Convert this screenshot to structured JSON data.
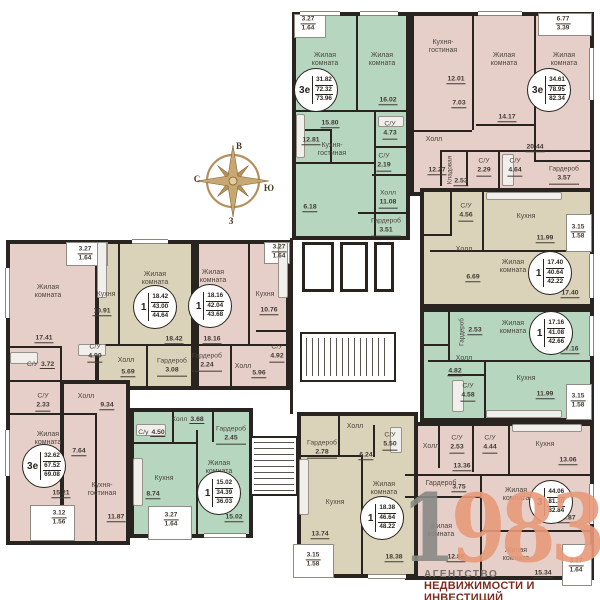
{
  "compass": {
    "top": "В",
    "left": "С",
    "right": "Ю",
    "bottom": "З"
  },
  "logo": {
    "year_gray": "1",
    "year_accent": "983",
    "line1": "АГЕНТСТВО",
    "line2": "НЕДВИЖИМОСТИ И ИНВЕСТИЦИЙ"
  },
  "colors": {
    "green": "#b7d6bf",
    "pink": "#e6cfc8",
    "beige": "#dbd3b9",
    "wall": "#29241f",
    "compass_gold": "#b3905e",
    "logo_salmon": "#e89a7a",
    "logo_gray": "#8a8a87",
    "logo_maroon": "#7c2d1e"
  },
  "apartments": [
    {
      "type": "3е",
      "v1": "31.82",
      "v2": "72.32",
      "v3": "73.96",
      "rooms": [
        {
          "name": "Жилая комната"
        },
        {
          "name": "Жилая комната",
          "area": "16.02"
        },
        {
          "name": "Кухня-гостиная",
          "area": "15.80"
        },
        {
          "area": "12.81"
        },
        {
          "area": "6.18"
        },
        {
          "name": "С/У",
          "area": "4.73"
        },
        {
          "name": "С/У",
          "area": "2.19"
        },
        {
          "name": "Холл",
          "area": "11.08"
        },
        {
          "name": "Гардероб",
          "area": "3.51"
        },
        {
          "fr1": "3.27",
          "fr2": "1.64"
        }
      ]
    },
    {
      "type": "3е",
      "v1": "34.61",
      "v2": "78.95",
      "v3": "82.34",
      "rooms": [
        {
          "name": "Кухня-гостиная",
          "area": "12.01"
        },
        {
          "name": "Жилая комната",
          "area": "14.17"
        },
        {
          "name": "Жилая комната",
          "area": "20.44"
        },
        {
          "name": "Холл",
          "area": "12.27"
        },
        {
          "area": "7.03"
        },
        {
          "name": "Кладовая",
          "area": "2.53"
        },
        {
          "name": "С/У",
          "area": "2.29"
        },
        {
          "name": "С/У",
          "area": "4.64"
        },
        {
          "name": "Гардероб",
          "area": "3.57"
        },
        {
          "fr1": "6.77",
          "fr2": "3.39"
        }
      ]
    },
    {
      "type": "1",
      "v1": "17.40",
      "v2": "40.64",
      "v3": "42.22",
      "rooms": [
        {
          "name": "Кухня",
          "area": "11.99"
        },
        {
          "name": "С/У",
          "area": "4.56"
        },
        {
          "name": "Холл",
          "area": "6.69"
        },
        {
          "name": "Жилая комната",
          "area": "17.40"
        },
        {
          "fr1": "3.15",
          "fr2": "1.58"
        }
      ]
    },
    {
      "type": "1",
      "v1": "17.16",
      "v2": "41.08",
      "v3": "42.66",
      "rooms": [
        {
          "name": "Жилая комната",
          "area": "17.16"
        },
        {
          "name": "Гардероб",
          "area": "2.53"
        },
        {
          "name": "Холл",
          "area": "4.82"
        },
        {
          "name": "С/У",
          "area": "4.58"
        },
        {
          "name": "Кухня",
          "area": "11.99"
        },
        {
          "fr1": "3.15",
          "fr2": "1.58"
        }
      ]
    },
    {
      "type": "3",
      "v1": "44.06",
      "v2": "81.20",
      "v3": "82.84",
      "rooms": [
        {
          "name": "С/У",
          "area": "2.53"
        },
        {
          "name": "С/У",
          "area": "4.44"
        },
        {
          "name": "Кухня",
          "area": "13.06"
        },
        {
          "name": "Холл",
          "area": "13.36"
        },
        {
          "name": "Гардероб",
          "area": "3.75"
        },
        {
          "name": "Жилая комната",
          "area": "15.87"
        },
        {
          "name": "Жилая комната",
          "area": "12.86"
        },
        {
          "name": "Жилая комната",
          "area": "15.34"
        },
        {
          "fr1": "3.27",
          "fr2": "1.64"
        }
      ]
    },
    {
      "type": "3е",
      "v1": "32.62",
      "v2": "67.52",
      "v3": "69.08",
      "rooms": [
        {
          "name": "Жилая комната",
          "area": "17.41"
        },
        {
          "name": "С/У",
          "area": "3.72"
        },
        {
          "name": "С/У",
          "area": "2.33"
        },
        {
          "name": "Холл",
          "area": "9.34"
        },
        {
          "area": "7.64"
        },
        {
          "name": "Жилая комната",
          "area": "15.21"
        },
        {
          "name": "Кухня-гостиная",
          "area": "11.87"
        },
        {
          "fr1": "3.27",
          "fr2": "1.64"
        },
        {
          "fr1": "3.12",
          "fr2": "1.56"
        }
      ]
    },
    {
      "type": "1",
      "v1": "18.42",
      "v2": "43.00",
      "v3": "44.64",
      "rooms": [
        {
          "name": "Кухня",
          "area": "10.91"
        },
        {
          "name": "Жилая комната",
          "area": "18.42"
        },
        {
          "name": "Холл",
          "area": "5.69"
        },
        {
          "name": "С/У",
          "area": "4.90"
        },
        {
          "name": "Гардероб",
          "area": "3.08"
        }
      ]
    },
    {
      "type": "1",
      "v1": "18.16",
      "v2": "42.04",
      "v3": "43.68",
      "rooms": [
        {
          "name": "Жилая комната",
          "area": "18.16"
        },
        {
          "name": "Гардероб",
          "area": "2.24"
        },
        {
          "name": "Холл",
          "area": "5.96"
        },
        {
          "name": "Кухня",
          "area": "10.76"
        },
        {
          "name": "С/У",
          "area": "4.92"
        },
        {
          "fr1": "3.27",
          "fr2": "1.64"
        }
      ]
    },
    {
      "type": "1",
      "v1": "15.02",
      "v2": "34.39",
      "v3": "36.03",
      "rooms": [
        {
          "name": "Холл",
          "area": "3.68"
        },
        {
          "name": "С/у",
          "area": "4.50"
        },
        {
          "name": "Гардероб",
          "area": "2.45"
        },
        {
          "name": "Кухня",
          "area": "8.74"
        },
        {
          "name": "Жилая комната",
          "area": "15.02"
        },
        {
          "fr1": "3.27",
          "fr2": "1.64"
        }
      ]
    },
    {
      "type": "1",
      "v1": "18.38",
      "v2": "46.64",
      "v3": "48.22",
      "rooms": [
        {
          "name": "Холл",
          "area": "6.24"
        },
        {
          "name": "С/У",
          "area": "5.50"
        },
        {
          "name": "Гардероб",
          "area": "2.78"
        },
        {
          "name": "Кухня",
          "area": "13.74"
        },
        {
          "name": "Жилая комната",
          "area": "18.38"
        },
        {
          "fr1": "3.15",
          "fr2": "1.58"
        }
      ]
    }
  ]
}
